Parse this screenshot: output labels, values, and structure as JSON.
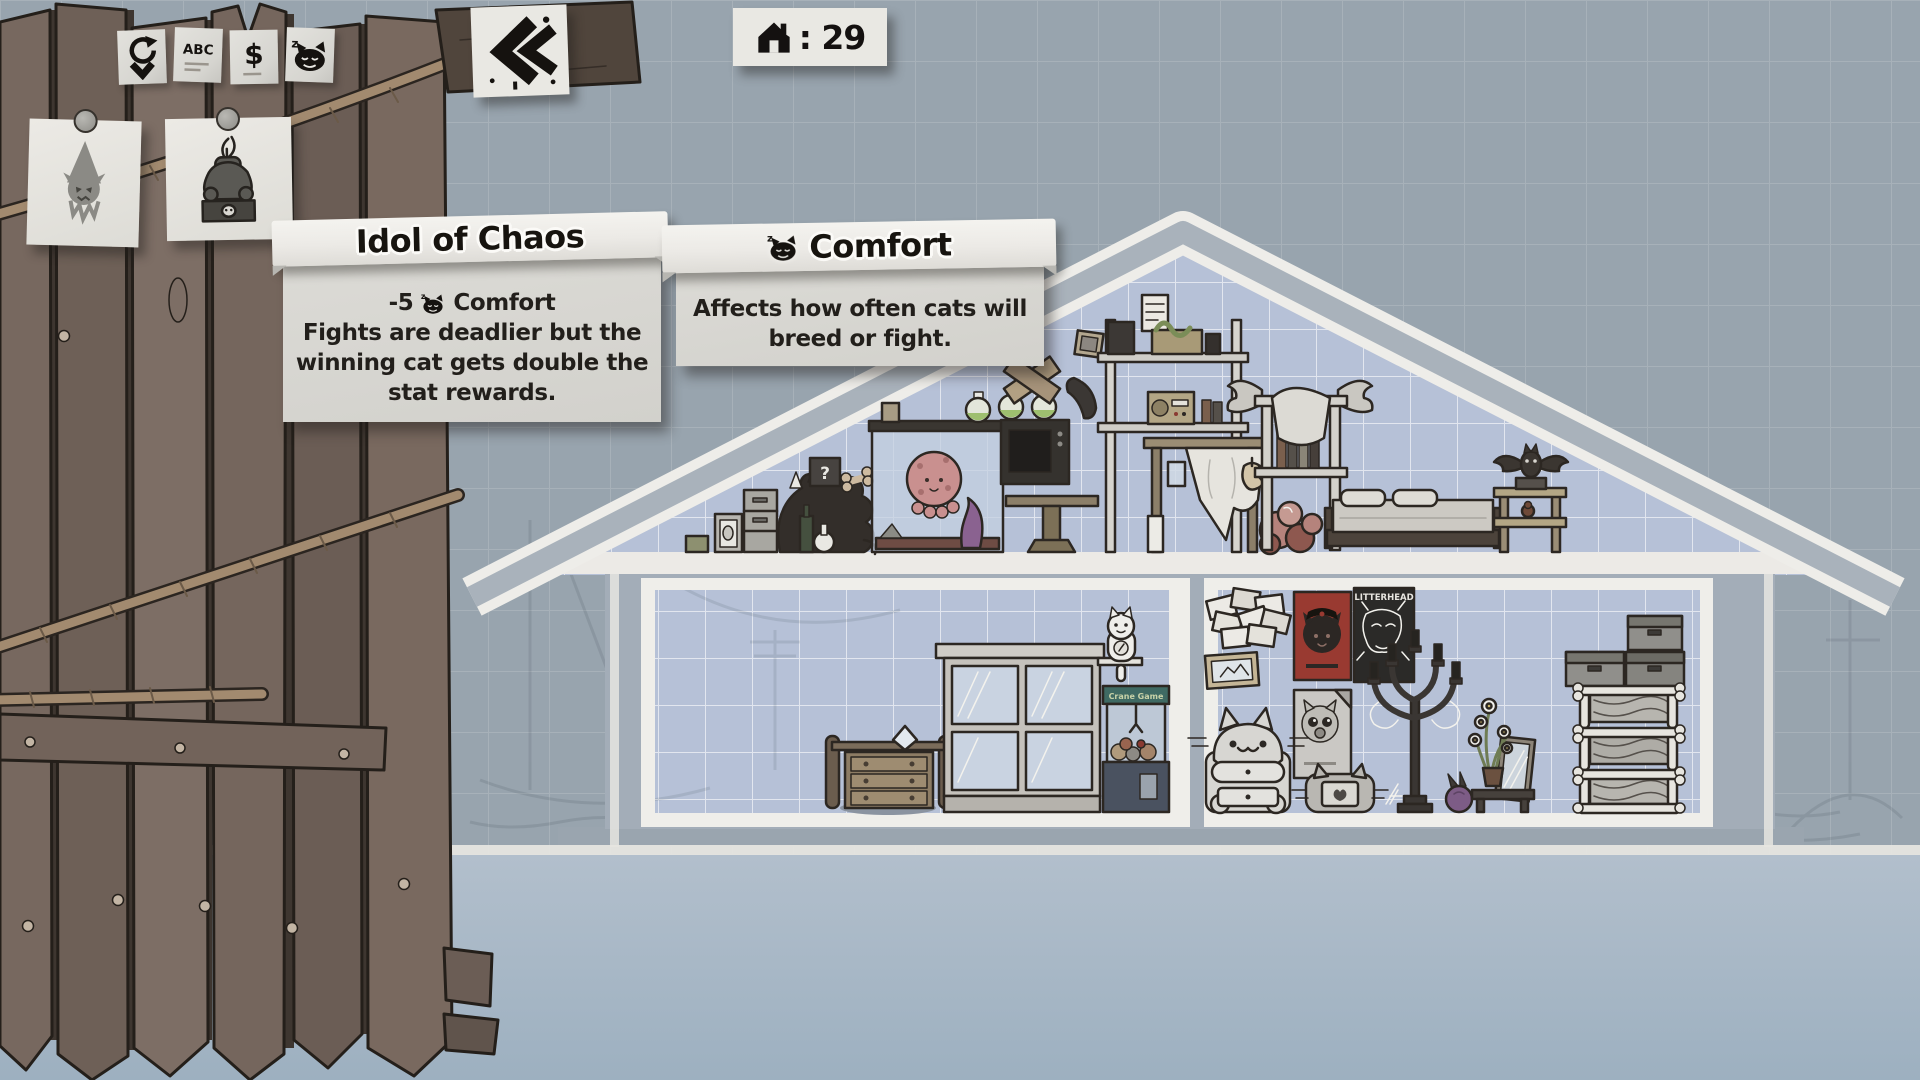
{
  "hud": {
    "back_button": {
      "icon": "double-chevron-left-icon"
    },
    "house_counter": {
      "icon": "house-icon",
      "value": ": 29"
    }
  },
  "toolbar_tabs": [
    {
      "id": "sort-recent",
      "icon": "circular-arrow-icon",
      "label": ""
    },
    {
      "id": "sort-alphabetical",
      "icon": "abc-label",
      "label": "ABC"
    },
    {
      "id": "sort-price",
      "icon": "dollar-label",
      "label": "$"
    },
    {
      "id": "sort-comfort",
      "icon": "sleeping-cat-icon",
      "label": ""
    }
  ],
  "item_cards": [
    {
      "id": "hooded-cat-item",
      "icon": "hooded-cat-icon"
    },
    {
      "id": "idol-of-chaos-item",
      "icon": "idol-statue-icon",
      "selected": true
    }
  ],
  "tooltips": {
    "item": {
      "title": "Idol of Chaos",
      "stat_prefix": "-5",
      "stat_icon": "comfort-cat-icon",
      "stat_name": "Comfort",
      "desc": "Fights are deadlier but the\nwinning cat gets double the\nstat rewards."
    },
    "stat": {
      "icon": "comfort-cat-icon",
      "title": "Comfort",
      "desc": "Affects how often cats will\nbreed or fight."
    }
  },
  "scene_labels": {
    "mystery_box": "?",
    "litterhead_poster": "LITTERHEAD",
    "claw_machine_marquee": "Crane Game"
  },
  "colors": {
    "paper": "#e9e8e3",
    "ink": "#17140f",
    "blueprint_wall": "#b6c1d7",
    "background": "#98a4ae",
    "fence_wood": "#77685f",
    "poster_red": "#993a31"
  }
}
